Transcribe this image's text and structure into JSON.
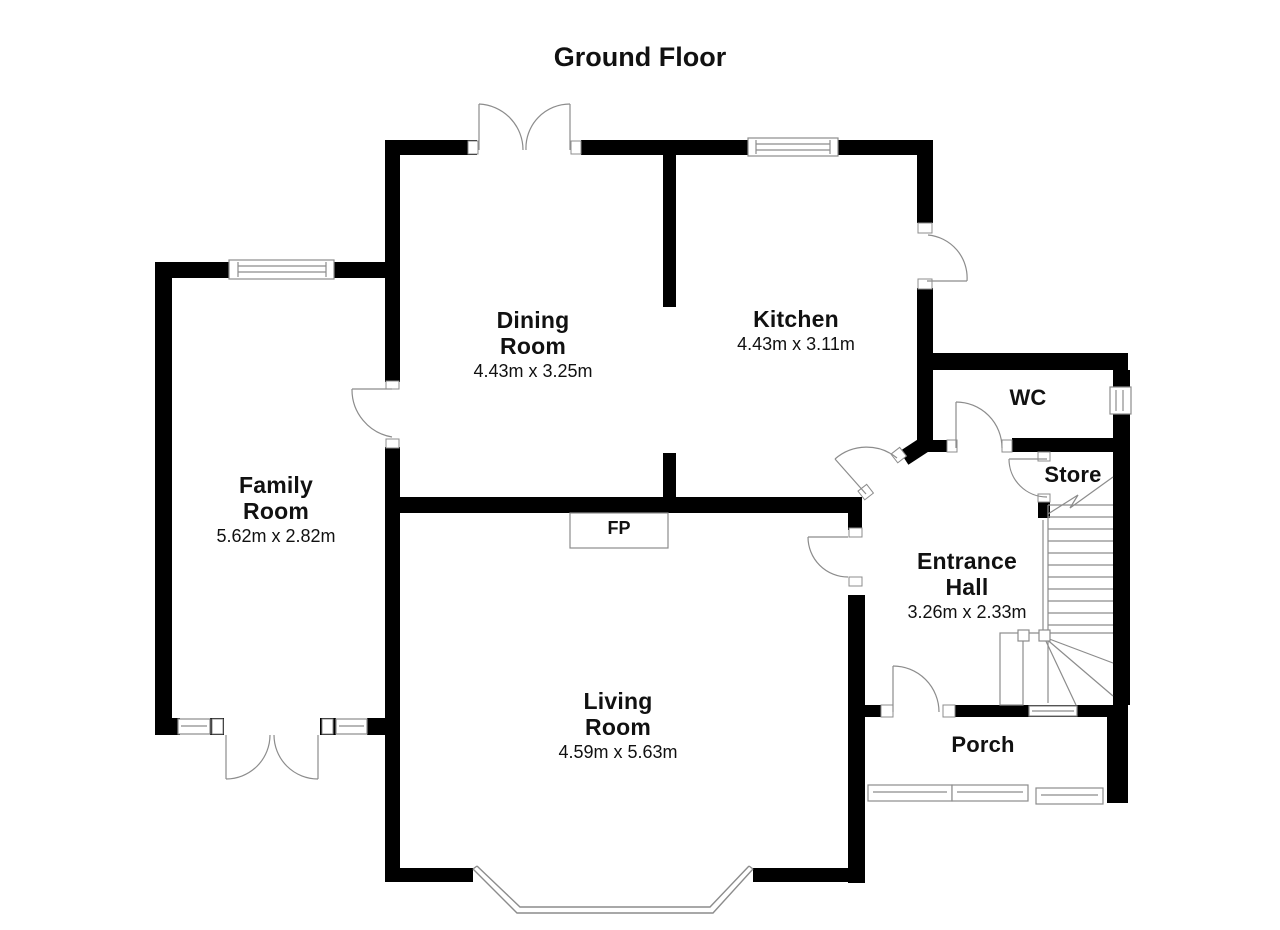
{
  "title": "Ground Floor",
  "rooms": [
    {
      "id": "dining-room",
      "name_lines": [
        "Dining",
        "Room"
      ],
      "dimensions": "4.43m x 3.25m"
    },
    {
      "id": "kitchen",
      "name_lines": [
        "Kitchen"
      ],
      "dimensions": "4.43m x 3.11m"
    },
    {
      "id": "family-room",
      "name_lines": [
        "Family",
        "Room"
      ],
      "dimensions": "5.62m x 2.82m"
    },
    {
      "id": "living-room",
      "name_lines": [
        "Living",
        "Room"
      ],
      "dimensions": "4.59m x 5.63m"
    },
    {
      "id": "entrance-hall",
      "name_lines": [
        "Entrance",
        "Hall"
      ],
      "dimensions": "3.26m x 2.33m"
    },
    {
      "id": "wc",
      "name_lines": [
        "WC"
      ]
    },
    {
      "id": "store",
      "name_lines": [
        "Store"
      ]
    },
    {
      "id": "porch",
      "name_lines": [
        "Porch"
      ]
    }
  ],
  "annotations": {
    "fireplace": "FP"
  },
  "colors": {
    "wall": "#000000",
    "line": "#8c8c8c",
    "background": "#ffffff",
    "text": "#111111"
  }
}
